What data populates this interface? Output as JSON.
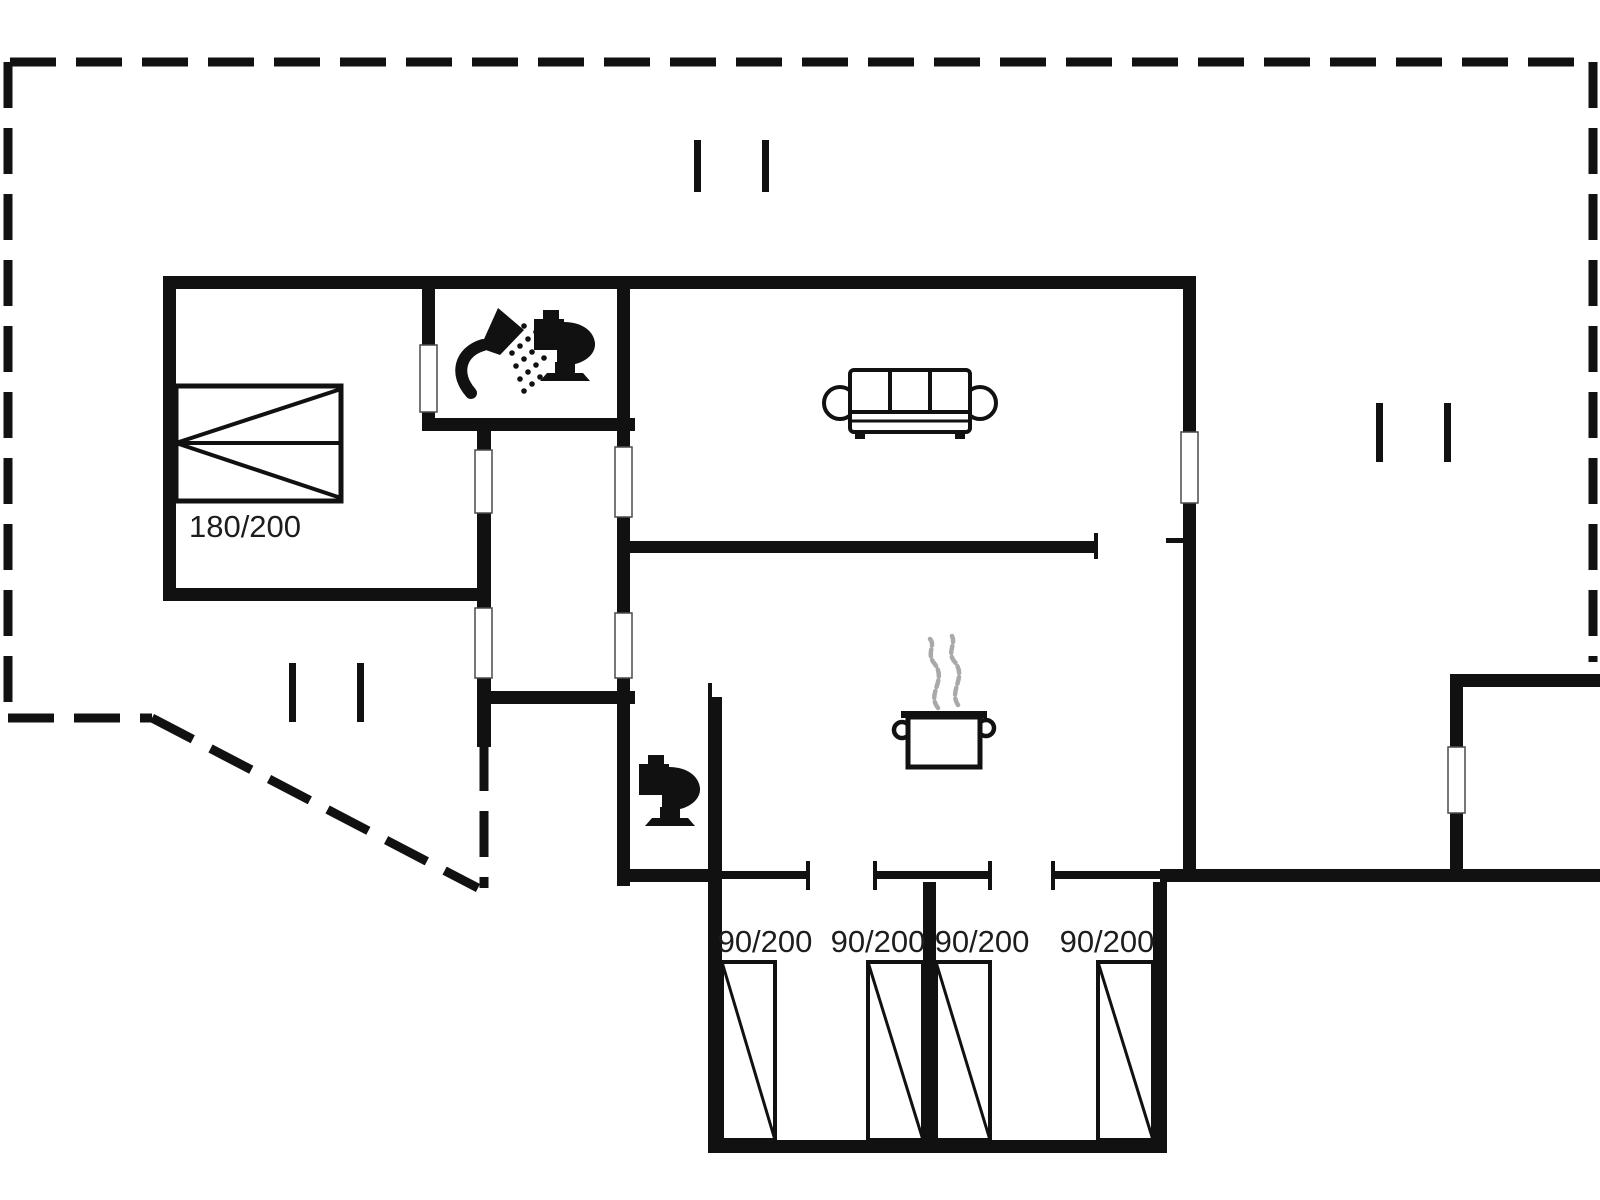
{
  "colors": {
    "wall": "#111111",
    "text": "#1d1d1d",
    "steam": "#a9a9a9",
    "background": "#ffffff"
  },
  "labels": {
    "double_bed": "180/200",
    "single_bed_1": "90/200",
    "single_bed_2": "90/200",
    "single_bed_3": "90/200",
    "single_bed_4": "90/200"
  },
  "icons": {
    "double_bed": "double-bed-icon",
    "single_bed": "single-bed-icon",
    "sofa": "sofa-icon",
    "cooking_pot": "cooking-pot-icon",
    "shower": "shower-icon",
    "toilet": "toilet-icon",
    "window": "window-symbol",
    "door": "door-opening-symbol"
  }
}
